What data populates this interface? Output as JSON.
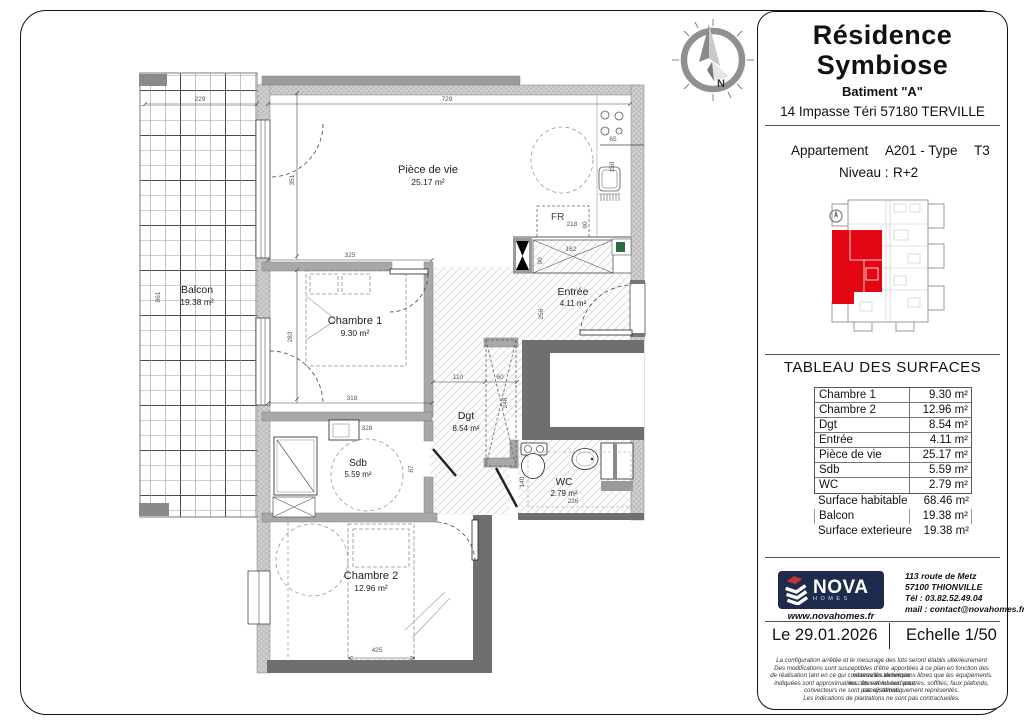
{
  "sheet": {
    "title_line1": "Résidence",
    "title_line2": "Symbiose",
    "building": "Batiment \"A\"",
    "address": "14 Impasse Téri 57180 TERVILLE",
    "apartment_label": "Appartement",
    "apartment_number": "A201 - Type",
    "apartment_type": "T3",
    "level_label": "Niveau :",
    "level_value": "R+2"
  },
  "surface_table": {
    "title": "TABLEAU DES SURFACES",
    "rows": [
      {
        "label": "Chambre 1",
        "value": "9.30 m²"
      },
      {
        "label": "Chambre 2",
        "value": "12.96 m²"
      },
      {
        "label": "Dgt",
        "value": "8.54 m²"
      },
      {
        "label": "Entrée",
        "value": "4.11 m²"
      },
      {
        "label": "Pièce de vie",
        "value": "25.17 m²"
      },
      {
        "label": "Sdb",
        "value": "5.59 m²"
      },
      {
        "label": "WC",
        "value": "2.79 m²"
      }
    ],
    "summary_rows": [
      {
        "label": "Surface habitable",
        "value": "68.46 m²"
      },
      {
        "label": "Balcon",
        "value": "19.38 m²"
      },
      {
        "label": "Surface exterieure",
        "value": "19.38 m²"
      }
    ]
  },
  "publisher": {
    "brand": "NOVA",
    "brand_sub": "HOMES",
    "website": "www.novahomes.fr",
    "address_line1": "113 route de Metz",
    "address_line2": "57100 THIONVILLE",
    "phone": "Tél : 03.82.52.49.04",
    "email": "mail : contact@novahomes.fr"
  },
  "footer": {
    "date": "Le 29.01.2026",
    "scale": "Echelle 1/50",
    "disclaimer": [
      "La configuration arrêtée et le mesurage des lots seront établis ultérieurement",
      "Des modifications sont susceptibles d'être apportées à ce plan en fonction des nécessités technique",
      "de réalisation tant en ce qui concerne les dimensions libres que les équipements. les côtes et les surfaces",
      "indiquées sont approximatives. les retombées, poutres, soffites, faux plafonds, canalisations,",
      "convecteurs ne sont pas systématiquement représentés.",
      "Les indications de plantations ne sont pas contractuelles."
    ]
  },
  "plan": {
    "rooms": {
      "piece_de_vie": {
        "name": "Pièce de vie",
        "area": "25.17 m²"
      },
      "chambre1": {
        "name": "Chambre 1",
        "area": "9.30 m²"
      },
      "chambre2": {
        "name": "Chambre 2",
        "area": "12.96 m²"
      },
      "entree": {
        "name": "Entrée",
        "area": "4.11 m²"
      },
      "dgt": {
        "name": "Dgt",
        "area": "8.54 m²"
      },
      "sdb": {
        "name": "Sdb",
        "area": "5.59 m²"
      },
      "wc": {
        "name": "WC",
        "area": "2.79 m²"
      },
      "balcon": {
        "name": "Balcon",
        "area": "19.38 m²"
      }
    },
    "labels": {
      "fridge": "FR"
    },
    "compass_letter": "N",
    "dimensions": {
      "d729": "729",
      "d325": "325",
      "d351": "351",
      "d283": "283",
      "d318": "318",
      "d328": "328",
      "d229": "229",
      "d861": "861",
      "d110": "110",
      "d60": "60",
      "d248": "248",
      "d256": "256",
      "d162": "162",
      "d90a": "90",
      "d218": "218",
      "d90b": "90",
      "d65": "65",
      "d150": "150",
      "d226": "226",
      "d425": "425",
      "d140": "140",
      "d87": "87"
    }
  },
  "colors": {
    "unit_highlight": "#e30613",
    "brand_navy": "#1e2b4d",
    "brand_red": "#c4372f",
    "accent_green": "#2e6b45"
  }
}
